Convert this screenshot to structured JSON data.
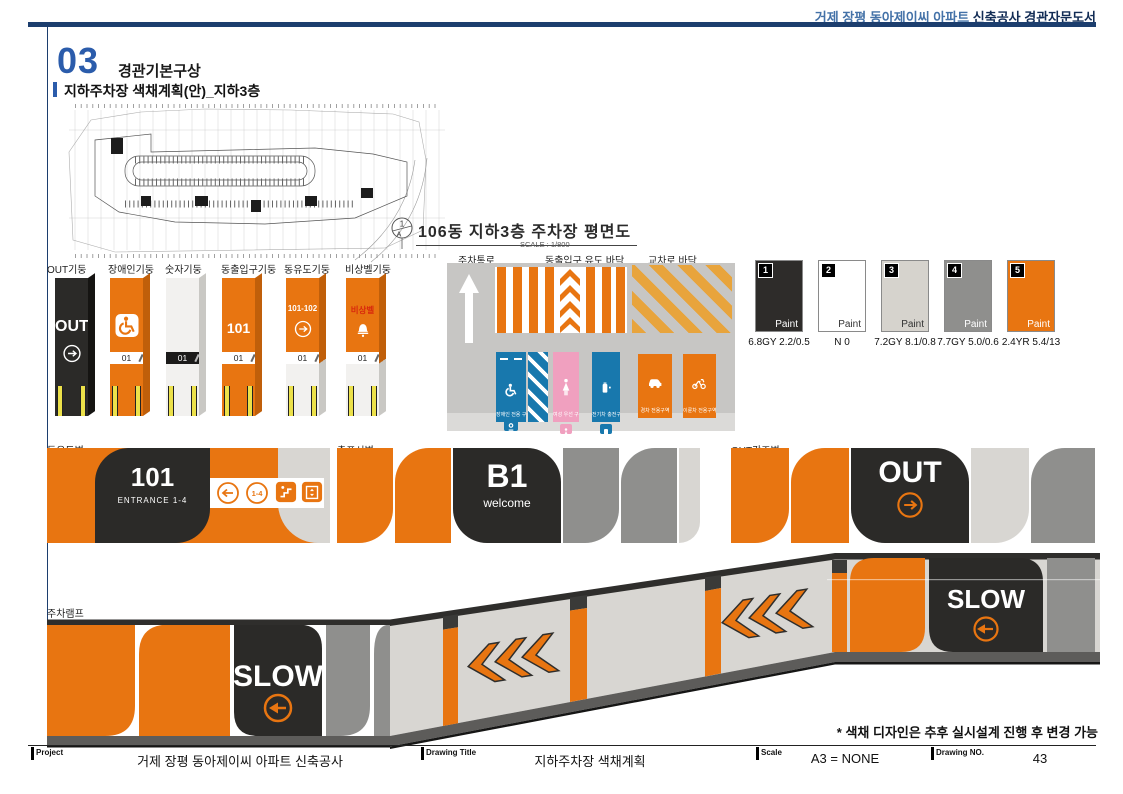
{
  "header": {
    "title_blue": "거제 장평 동아제이씨 아파트",
    "title_dark": "신축공사 경관자문도서"
  },
  "section": {
    "number": "03",
    "title": "경관기본구상",
    "subtitle": "지하주차장 색채계획(안)_지하3층"
  },
  "plan": {
    "title": "106동 지하3층 주차장 평면도",
    "scale": "SCALE : 1/800",
    "marker_top": "1",
    "marker_bottom": "A"
  },
  "pillars": {
    "items": [
      {
        "label": "OUT기둥",
        "main": "OUT"
      },
      {
        "label": "장애인기둥",
        "band": "01"
      },
      {
        "label": "숫자기둥",
        "band": "01"
      },
      {
        "label": "동출입구기둥",
        "main": "101",
        "band": "01"
      },
      {
        "label": "동유도기둥",
        "main": "101-102",
        "band": "01"
      },
      {
        "label": "비상벨기둥",
        "main": "비상벨",
        "band": "01"
      }
    ]
  },
  "floor": {
    "label_aisle": "주차통로",
    "label_guide": "동출입구 유도 바닥",
    "label_cross": "교차로 바닥",
    "stalls": [
      {
        "name": "장애인 전용 구역"
      },
      {
        "name": "여성 우선 구역"
      },
      {
        "name": "전기차 충전구역"
      },
      {
        "name": "경차 전용구역"
      },
      {
        "name": "이륜차 전용구역"
      }
    ]
  },
  "swatches": [
    {
      "no": "1",
      "finish": "Paint",
      "code": "6.8GY 2.2/0.5",
      "color": "#2e2c2a"
    },
    {
      "no": "2",
      "finish": "Paint",
      "code": "N 0",
      "color": "#ffffff"
    },
    {
      "no": "3",
      "finish": "Paint",
      "code": "7.2GY 8.1/0.8",
      "color": "#d6d3cd"
    },
    {
      "no": "4",
      "finish": "Paint",
      "code": "7.7GY 5.0/0.6",
      "color": "#8f8f8d"
    },
    {
      "no": "5",
      "finish": "Paint",
      "code": "2.4YR 5.4/13",
      "color": "#e87511"
    }
  ],
  "walls": {
    "guide": {
      "label": "동유도벽",
      "number": "101",
      "entrance": "ENTRANCE 1-4",
      "range": "1-4"
    },
    "floor_sign": {
      "label": "층표시벽",
      "main": "B1",
      "sub": "welcome"
    },
    "out": {
      "label": "OUT강조벽",
      "main": "OUT"
    }
  },
  "ramp": {
    "label": "주차램프",
    "slow": "SLOW"
  },
  "note": "* 색채 디자인은 추후 실시설계 진행 후 변경 가능",
  "footer": {
    "project_label": "Project",
    "project": "거제 장평 동아제이씨 아파트 신축공사",
    "title_label": "Drawing Title",
    "title": "지하주차장 색채계획",
    "scale_label": "Scale",
    "scale": "A3 = NONE",
    "no_label": "Drawing NO.",
    "no": "43"
  }
}
